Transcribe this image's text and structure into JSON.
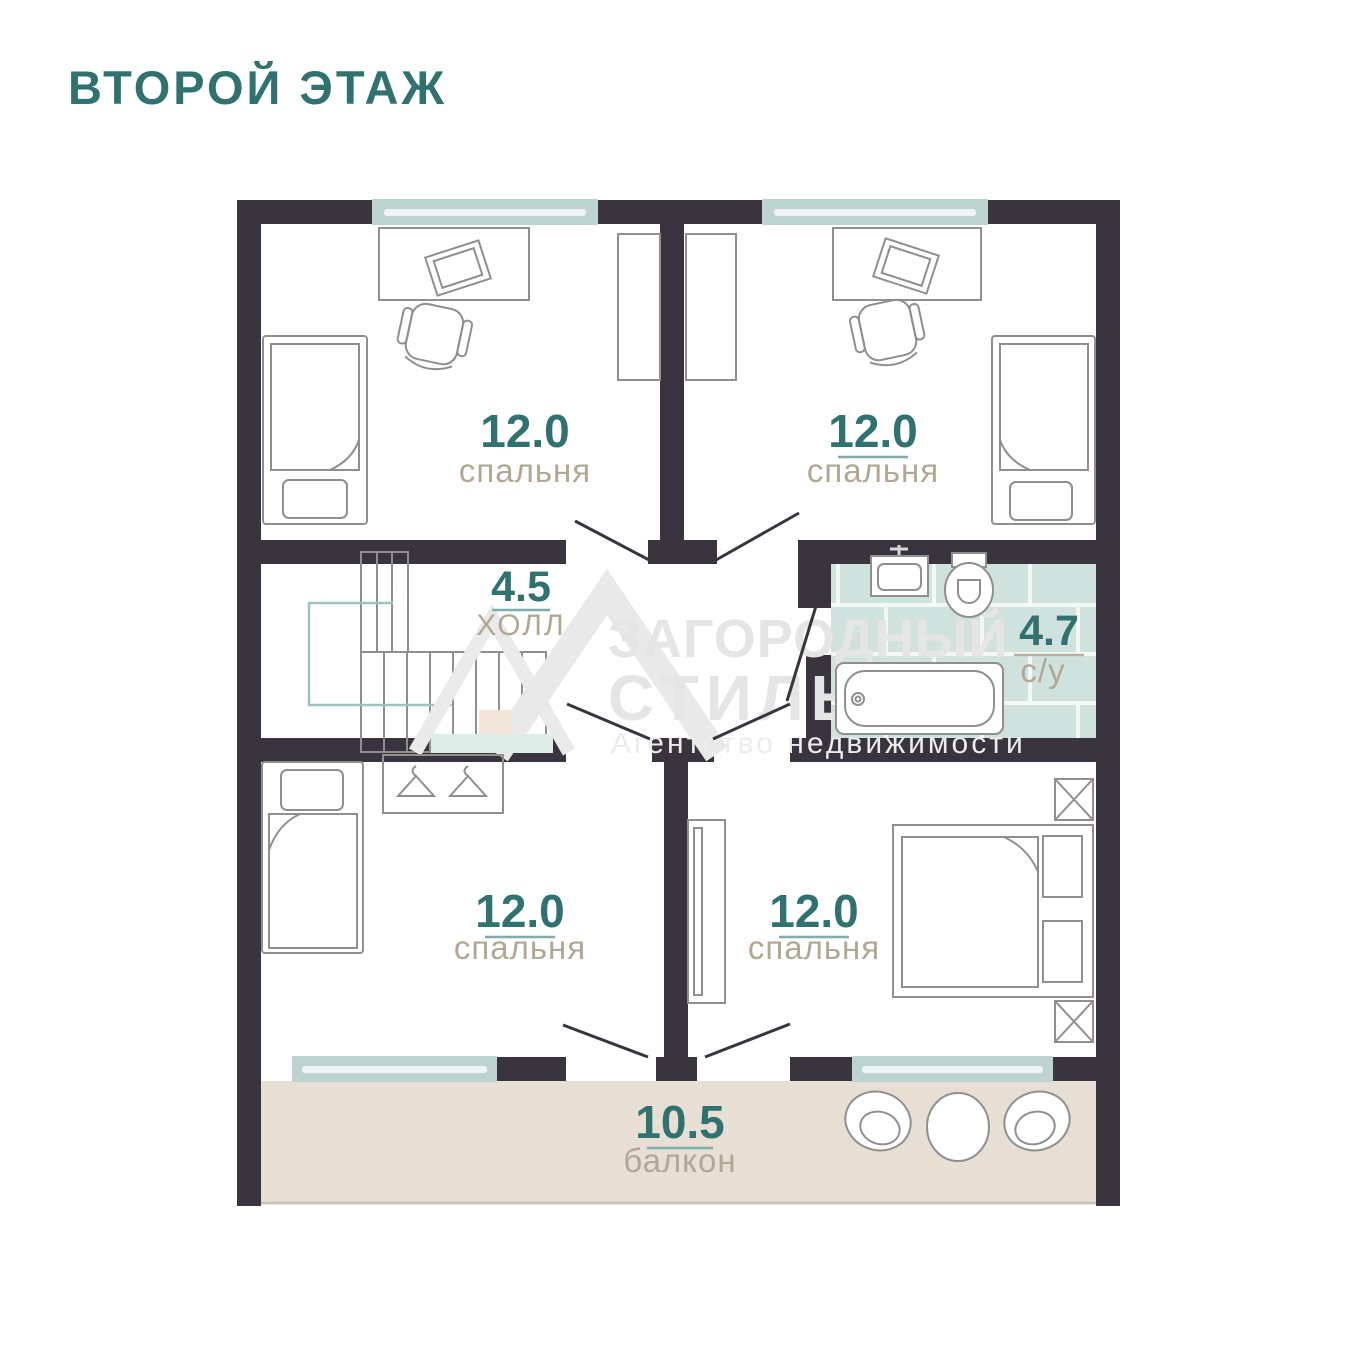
{
  "header": {
    "title": "ВТОРОЙ ЭТАЖ"
  },
  "rooms": {
    "top_left": {
      "area": "12.0",
      "name": "спальня"
    },
    "top_right": {
      "area": "12.0",
      "name": "спальня"
    },
    "hall": {
      "area": "4.5",
      "name": "ХОЛЛ"
    },
    "bathroom": {
      "area": "4.7",
      "name": "с/у"
    },
    "bottom_left": {
      "area": "12.0",
      "name": "спальня"
    },
    "bottom_right": {
      "area": "12.0",
      "name": "спальня"
    },
    "balcony": {
      "area": "10.5",
      "name": "балкон"
    }
  },
  "watermark": {
    "brand_line1": "ЗАГОРОДНЫЙ",
    "brand_line2": "СТИЛЬ",
    "tagline": "Агентство недвижимости"
  },
  "palette": {
    "wall": "#3a343e",
    "teal": "#2f7270",
    "beige": "#b2a793",
    "window": "#bcd3cf",
    "tile": "#d0e2de",
    "grout": "#f3f8f7",
    "balcony": "#e7dfd4",
    "wm": "#e5e5e5",
    "outline": "#8f8f8f"
  }
}
